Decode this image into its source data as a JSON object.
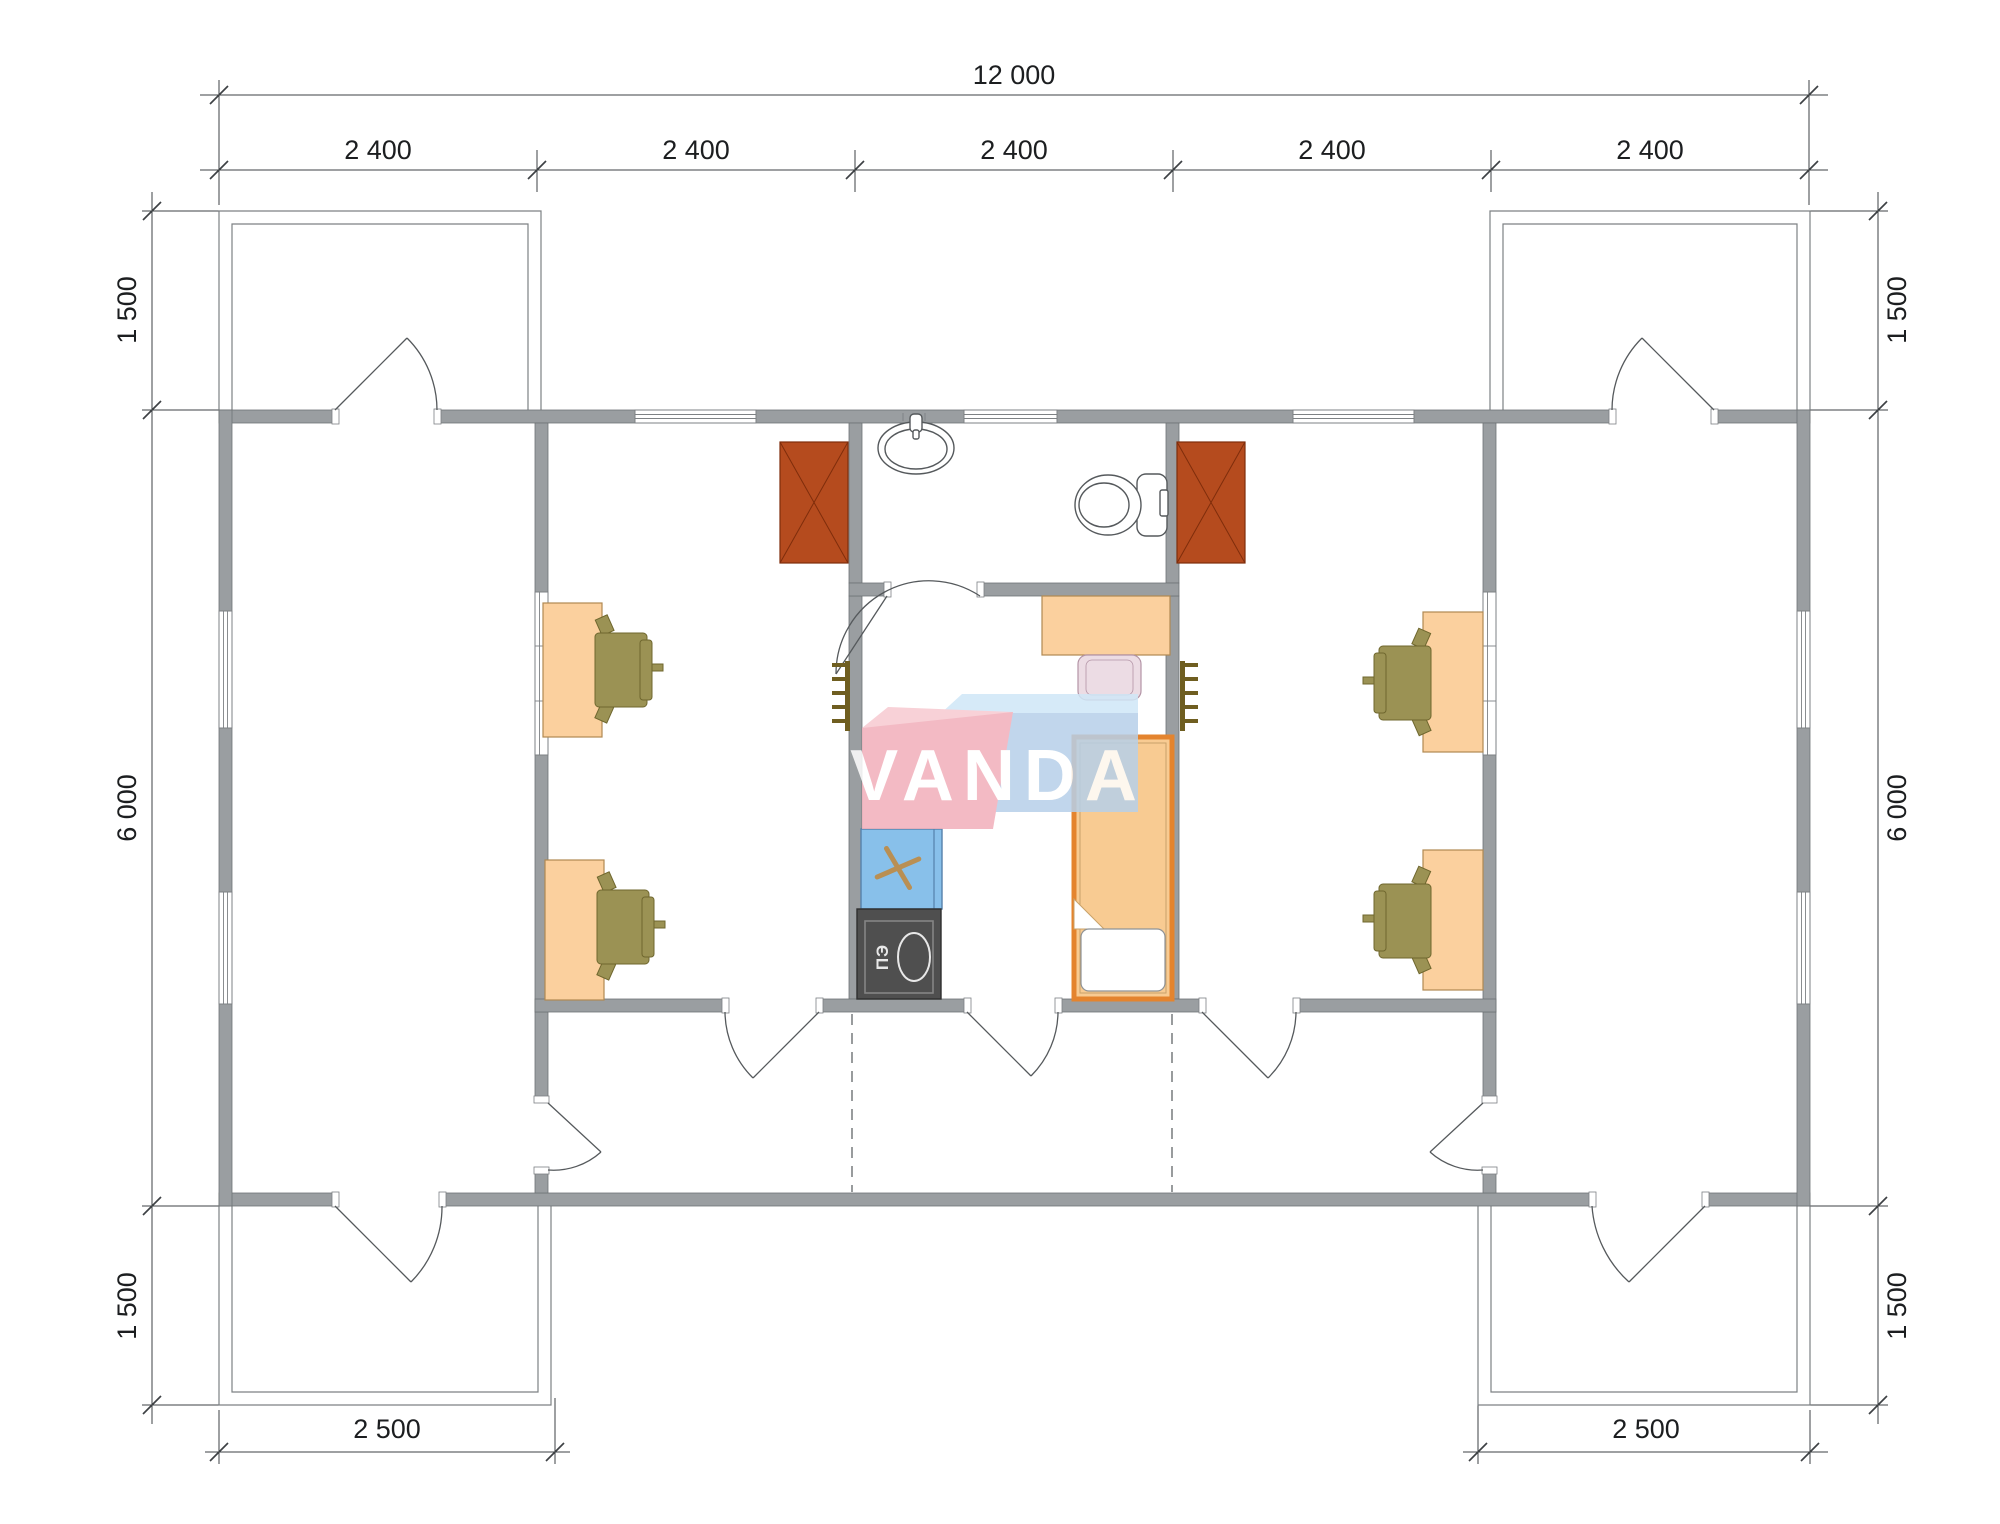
{
  "drawing": {
    "logo": {
      "text": "VANDA"
    },
    "stove_label": "ПЭ",
    "dimensions": {
      "top_total": "12 000",
      "top_modules": [
        "2 400",
        "2 400",
        "2 400",
        "2 400",
        "2 400"
      ],
      "left": [
        "1 500",
        "6 000",
        "1 500"
      ],
      "right": [
        "1 500",
        "6 000",
        "1 500"
      ],
      "bottom_left": "2 500",
      "bottom_right": "2 500"
    },
    "colors": {
      "wall": "#9a9ea1",
      "wall_stroke": "#6f7376",
      "thin": "#7d8184",
      "line": "#55595c",
      "dim": "#3d4144",
      "dimtext": "#1c1e20",
      "furniture_peach": "#fbd09e",
      "furniture_peach_stroke": "#b08952",
      "chair_olive": "#9b9254",
      "chair_olive_stroke": "#6f672e",
      "wardrobe": "#b54b1e",
      "wardrobe_stroke": "#7f2d0b",
      "counter_blue": "#88c0ea",
      "counter_stroke": "#5581ab",
      "cross_tan": "#b98f53",
      "stove_dark": "#4f4f4f",
      "stove_stroke": "#2f2f2f",
      "stove_light": "#e8e8e8",
      "bed_orange": "#e4842e",
      "bed_fill": "#f8cb92",
      "bed_inner": "#c9a269",
      "pillow_stroke": "#8f9396",
      "chair_pink": "#ecdce4",
      "chair_pink_stroke": "#b394a6",
      "radiator": "#6f5e20",
      "logo_pink": "#f2afba",
      "logo_pink_light": "#f7cad1",
      "logo_blue": "#b7d0e9",
      "logo_blue_light": "#d0e7f7",
      "logo_text": "#ffffff"
    }
  }
}
